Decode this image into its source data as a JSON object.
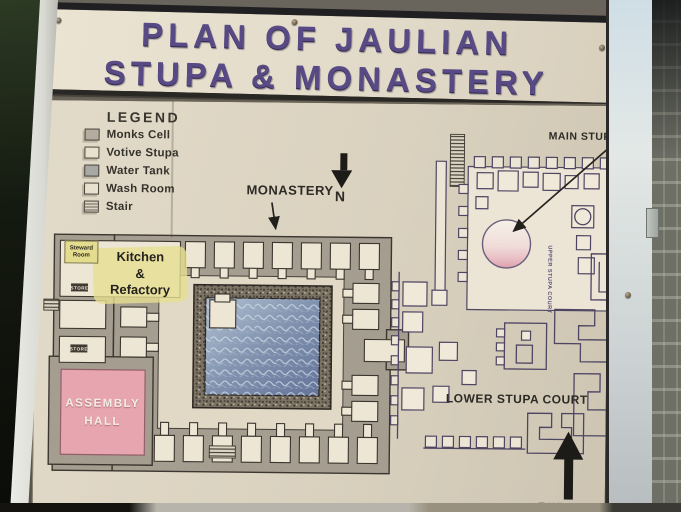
{
  "sign": {
    "title_line1": "PLAN OF JAULIAN",
    "title_line2": "STUPA & MONASTERY"
  },
  "legend": {
    "heading": "LEGEND",
    "items": [
      {
        "label": "Monks Cell",
        "swatch": "monks-cell-swatch"
      },
      {
        "label": "Votive Stupa",
        "swatch": "votive-stupa-swatch"
      },
      {
        "label": "Water Tank",
        "swatch": "water-tank-swatch"
      },
      {
        "label": "Wash Room",
        "swatch": "wash-room-swatch"
      },
      {
        "label": "Stair",
        "swatch": "stair-swatch"
      }
    ]
  },
  "map": {
    "monastery_label": "MONASTERY",
    "north_label": "N",
    "main_stupa_label": "MAIN STUPA",
    "lower_stupa_court_label": "LOWER STUPA COURT",
    "upper_court_vertical_label": "UPPER STUPA COURT",
    "entrance_label": "ENTRANCE",
    "assembly_hall_line1": "ASSEMBLY",
    "assembly_hall_line2": "HALL",
    "kitchen_line1": "Kitchen",
    "kitchen_line2": "&",
    "kitchen_line3": "Refactory",
    "steward_room_label": "Steward Room",
    "store_label": "STORE"
  },
  "colors": {
    "board_cream": "#ddd5c2",
    "title_purple": "#584a84",
    "wall_gray": "#a59d90",
    "assembly_pink": "#e7a6af",
    "water_blue": "#8092ae",
    "kitchen_highlight": "#e6df90",
    "steward_yellow": "#e3dc8e",
    "court_outline_purple": "#4e4563",
    "arrow_black": "#1d1b17"
  }
}
